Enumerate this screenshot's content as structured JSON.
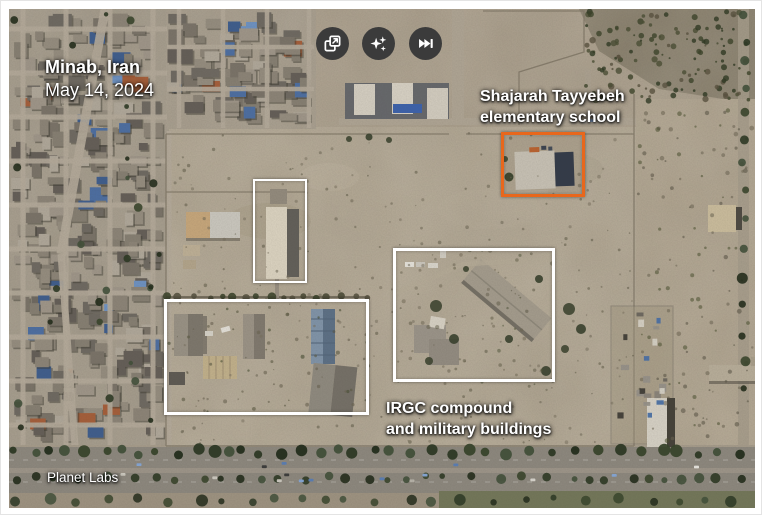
{
  "header": {
    "location": "Minab, Iran",
    "date": "May 14, 2024"
  },
  "toolbar": {
    "background_color": "#3b3b3b",
    "icon_color": "#ffffff",
    "buttons": [
      {
        "icon": "open-in-new-icon"
      },
      {
        "icon": "sparkles-icon"
      },
      {
        "icon": "skip-to-end-icon"
      }
    ]
  },
  "annotations": {
    "school": {
      "label_line1": "Shajarah Tayyebeh",
      "label_line2": "elementary school",
      "box_color": "#e8671c"
    },
    "irgc": {
      "label_line1": "IRGC compound",
      "label_line2": "and military buildings",
      "box_color": "#ffffff"
    }
  },
  "credit": "Planet Labs"
}
